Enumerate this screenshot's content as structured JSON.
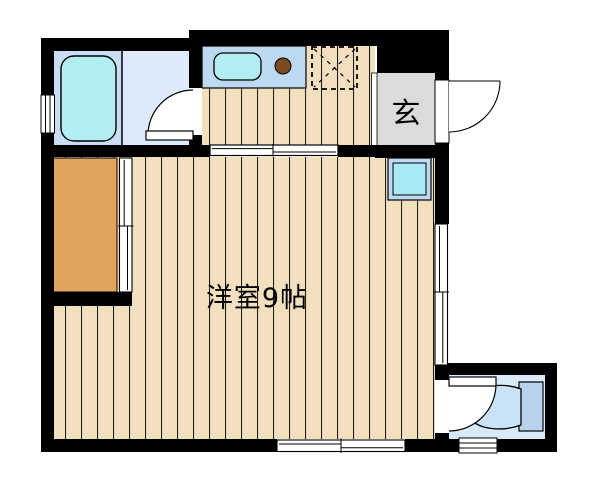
{
  "plan": {
    "rooms": {
      "main_room": {
        "label": "洋室9帖"
      },
      "entrance": {
        "label": "玄"
      }
    },
    "colors": {
      "wall": "#000000",
      "wood_floor": "#F2DFBE",
      "plank_line": "#1b1b1b",
      "bathroom_floor": "#C9DDF4",
      "washroom_floor": "#DCEAFB",
      "bathtub": "#B2EDF2",
      "counter": "#BDD9F2",
      "sink": "#B2EDF2",
      "burner": "#7A4A21",
      "genkan_floor": "#DBDBDB",
      "closet": "#E1A45F",
      "washer_outer": "#BFD9F0",
      "washer_inner": "#A9E9F4",
      "toilet_floor": "#D8EAF8",
      "toilet_tank": "#B9D2EC",
      "toilet_bowl": "#C9E2F6"
    }
  }
}
